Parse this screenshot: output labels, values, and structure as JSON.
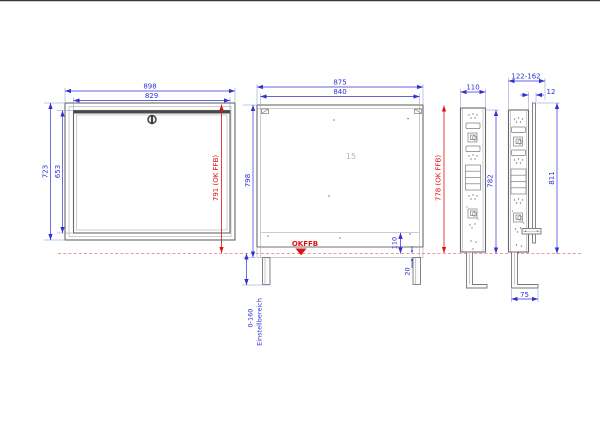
{
  "drawing": {
    "front": {
      "w_outer": "898",
      "w_inner": "829",
      "h_outer": "723",
      "h_inner": "653",
      "h_floor": "791 (OK FFB)"
    },
    "open": {
      "w_outer": "875",
      "w_inner": "840",
      "h_total": "798",
      "h_floor": "778 (OK FFB)",
      "plate_height": "110",
      "base_depth": "20",
      "floor_label": "OKFFB",
      "mark": "15",
      "adjust_range": "0-160",
      "adjust_label": "Einstellbereich"
    },
    "side1": {
      "depth": "110",
      "height": "782"
    },
    "side2": {
      "depth": "122-162",
      "offset": "12",
      "height": "811",
      "foot": "75"
    },
    "colors": {
      "dimension_blue": "#2f2fd3",
      "dimension_red": "#e01010",
      "floor_dash_red": "#ef9a9a",
      "part_line_gray": "#686868"
    }
  }
}
